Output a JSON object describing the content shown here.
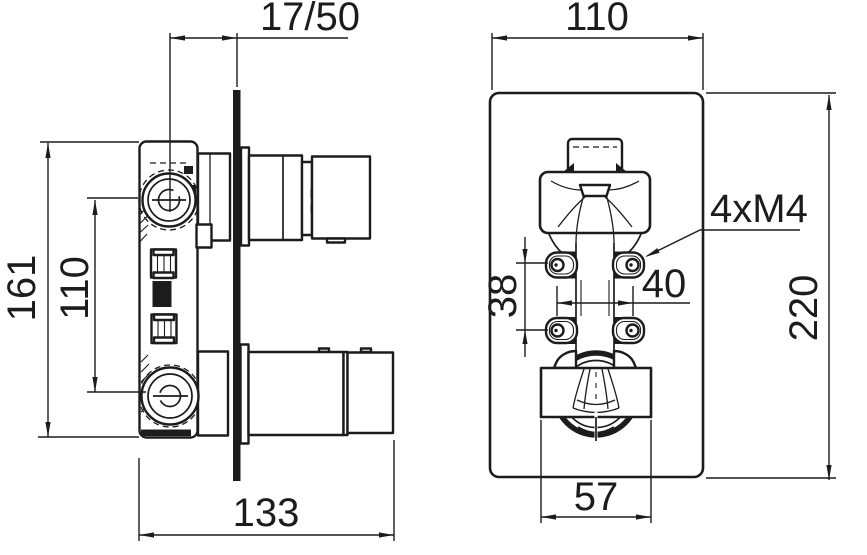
{
  "colors": {
    "ink": "#1c1c1c",
    "paper": "#ffffff"
  },
  "side_view": {
    "wall_offset": "17/50",
    "body_height": "161",
    "port_spacing": "110",
    "total_depth": "133"
  },
  "front_view": {
    "plate_width": "110",
    "plate_height": "220",
    "screw_spec": "4xM4",
    "screw_gap_vertical": "38",
    "screw_gap_horizontal": "40",
    "trim_width": "57"
  }
}
